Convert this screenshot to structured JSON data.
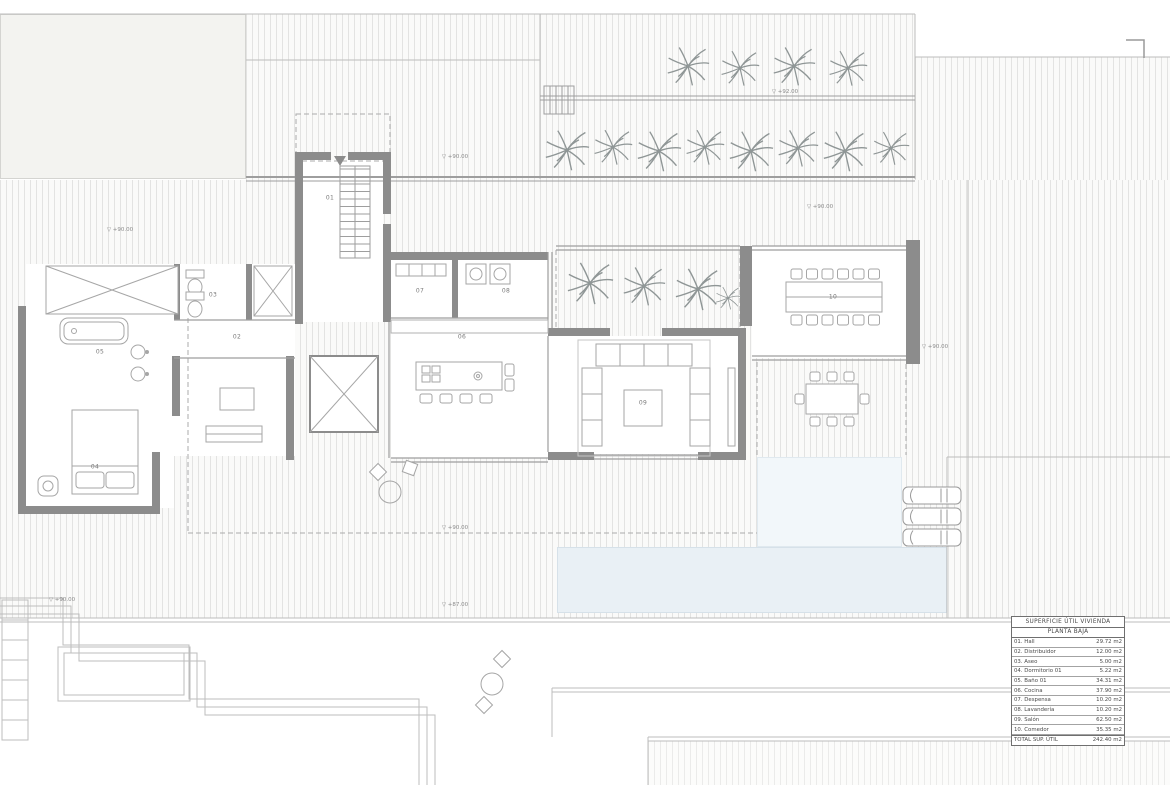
{
  "area_table": {
    "title": "SUPERFICIE ÚTIL VIVIENDA",
    "subtitle": "PLANTA BAJA",
    "rows": [
      {
        "label": "01. Hall",
        "value": "29.72 m2"
      },
      {
        "label": "02. Distribuidor",
        "value": "12.00 m2"
      },
      {
        "label": "03. Aseo",
        "value": "5.00 m2"
      },
      {
        "label": "04. Dormitorio 01",
        "value": "5.22 m2"
      },
      {
        "label": "05. Baño 01",
        "value": "34.31 m2"
      },
      {
        "label": "06. Cocina",
        "value": "37.90 m2"
      },
      {
        "label": "07. Despensa",
        "value": "10.20 m2"
      },
      {
        "label": "08. Lavandería",
        "value": "10.20 m2"
      },
      {
        "label": "09. Salón",
        "value": "62.50 m2"
      },
      {
        "label": "10. Comedor",
        "value": "35.35 m2"
      }
    ],
    "total": {
      "label": "TOTAL SUP. ÚTIL",
      "value": "242.40 m2"
    }
  },
  "plan": {
    "level_glyph": "▽",
    "rooms": [
      {
        "num": "01",
        "x": 330,
        "y": 198
      },
      {
        "num": "02",
        "x": 237,
        "y": 337
      },
      {
        "num": "03",
        "x": 213,
        "y": 295
      },
      {
        "num": "04",
        "x": 95,
        "y": 467
      },
      {
        "num": "05",
        "x": 100,
        "y": 352
      },
      {
        "num": "06",
        "x": 462,
        "y": 337
      },
      {
        "num": "07",
        "x": 420,
        "y": 291
      },
      {
        "num": "08",
        "x": 506,
        "y": 291
      },
      {
        "num": "09",
        "x": 643,
        "y": 403
      },
      {
        "num": "10",
        "x": 833,
        "y": 297
      }
    ],
    "levels": [
      {
        "value": "+92.00",
        "x": 785,
        "y": 92
      },
      {
        "value": "+90.00",
        "x": 455,
        "y": 157
      },
      {
        "value": "+90.00",
        "x": 820,
        "y": 207
      },
      {
        "value": "+90.00",
        "x": 120,
        "y": 230
      },
      {
        "value": "+90.00",
        "x": 935,
        "y": 347
      },
      {
        "value": "+90.00",
        "x": 455,
        "y": 528
      },
      {
        "value": "+87.00",
        "x": 455,
        "y": 605
      },
      {
        "value": "+90.00",
        "x": 62,
        "y": 600
      }
    ],
    "palms": [
      [
        688,
        66,
        44
      ],
      [
        740,
        68,
        40
      ],
      [
        794,
        66,
        44
      ],
      [
        848,
        68,
        40
      ],
      [
        567,
        150,
        46
      ],
      [
        613,
        147,
        40
      ],
      [
        659,
        151,
        46
      ],
      [
        705,
        147,
        40
      ],
      [
        751,
        151,
        46
      ],
      [
        798,
        148,
        42
      ],
      [
        845,
        151,
        46
      ],
      [
        891,
        148,
        38
      ],
      [
        590,
        283,
        48
      ],
      [
        644,
        286,
        44
      ],
      [
        698,
        289,
        48
      ],
      [
        728,
        298,
        26
      ]
    ],
    "cars": [
      [
        903,
        487
      ],
      [
        903,
        508
      ],
      [
        903,
        529
      ]
    ],
    "colors": {
      "wall": "#8c8c8c",
      "hatch_line": "#e3e3e2",
      "pool": "#e9f0f5",
      "pool_upper": "#f2f7fa",
      "furniture_line": "#a6a6a6",
      "text": "#7a7a7a"
    }
  }
}
